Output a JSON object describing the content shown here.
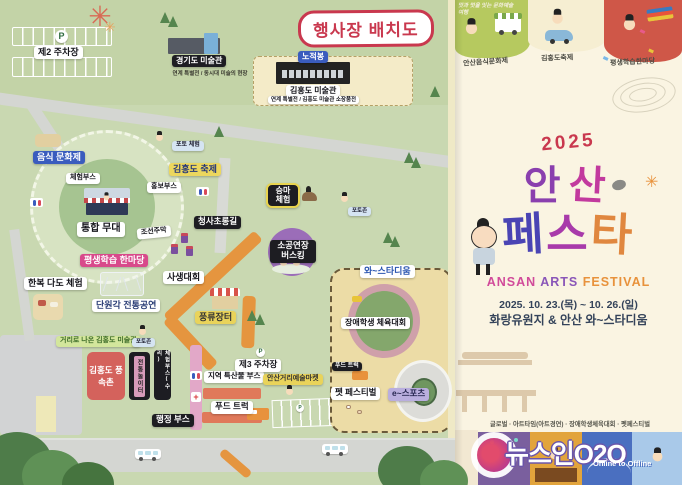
{
  "map": {
    "title": "행사장 배치도",
    "labels": {
      "p": "P",
      "parking2": "제2 주차장",
      "parking3": "제3 주차장",
      "gyeonggi_museum": "경기도 미술관",
      "gyeonggi_museum_sub": "연계 특별전 / 동시대 미술의 현장",
      "nojeokbong": "노적봉",
      "kimhongdo_museum": "김홍도 미술관",
      "kimhongdo_museum_sub": "연계 특별전 / 김홍도 미술관 소장품전",
      "food_culture_festival": "음식 문화제",
      "experience_booth": "체험부스",
      "promo_booth": "홍보부스",
      "photo_experience": "포토 체험",
      "kimhongdo_festival": "김홍도 축제",
      "main_stage": "통합 무대",
      "joseon_tavern": "조선주막",
      "lantern_road": "청사초롱길",
      "horse_riding": "승마 체험",
      "photozone_a": "포토존",
      "busking": "소공연장 버스킹",
      "lifelong_learning": "평생학습 한마당",
      "sketch_contest": "사생대회",
      "hanbok_tea": "한복 다도 체험",
      "danwongak_show": "단원각 전통공연",
      "street_museum": "거리로 나온 김홍도 미술관",
      "photozone_b": "포토존",
      "folk_village": "김홍도 풍속촌",
      "trad_playground": "전통놀이터",
      "booth_repair": "체험부스(수리)",
      "pungnyu_market": "풍류장터",
      "admin_booth": "행정 부스",
      "local_goods_booth": "지역 특산물 부스",
      "street_art_market": "안산거리예술마켓",
      "food_truck_a": "푸드 트럭",
      "wa_stadium": "와~스타디움",
      "disabled_sports": "장애학생 체육대회",
      "food_truck_b": "푸드 트럭",
      "pet_festival": "펫 페스티벌",
      "esports": "e~스포츠"
    }
  },
  "poster": {
    "slogan": "맛과 멋을 잇는 문화예술 여행",
    "event_tabs": [
      "안산음식문화제",
      "김홍도축제",
      "평생학습한마당"
    ],
    "year": "2025",
    "title1": [
      "안",
      "산"
    ],
    "title2": [
      "페",
      "스",
      "타"
    ],
    "title_en": [
      "ANSAN",
      "ARTS",
      "FESTIVAL"
    ],
    "date_text": "2025. 10. 23.(목) ~ 10. 26.(일)",
    "venue_text": "화랑유원지 & 안산 와~스타디움",
    "sub_events": "글로벌 · 아트타임(아트경연) · 장애학생체육대회 · 펫페스티벌"
  },
  "watermark": {
    "brand": "뉴스인O2O",
    "tagline": "Online to Offline"
  },
  "colors": {
    "map_green": "#c9d8b1",
    "path_orange": "#e5953f",
    "accent_red": "#c9384e",
    "poster_cream": "#faf4e2"
  }
}
